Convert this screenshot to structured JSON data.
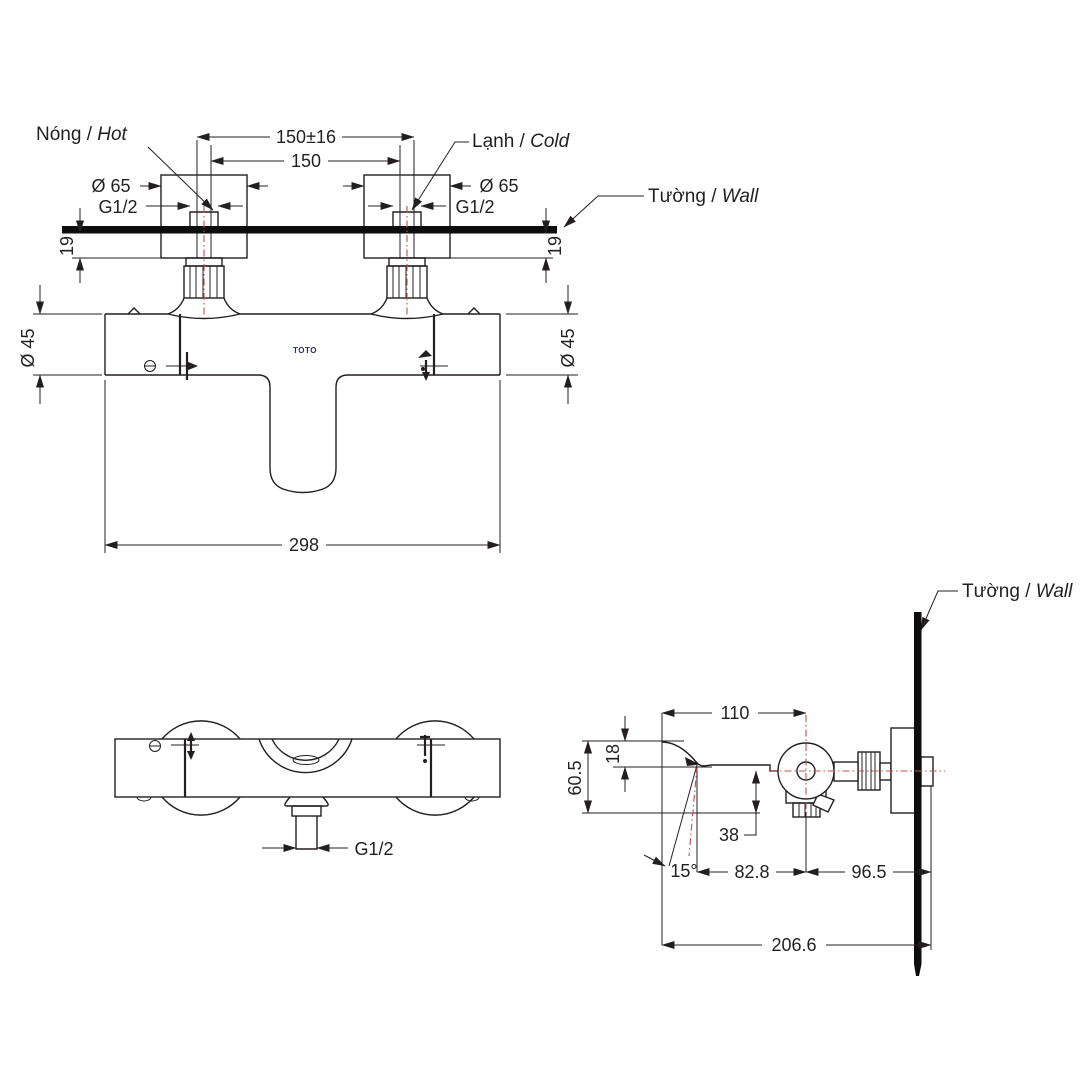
{
  "front_view": {
    "hot_label_vi": "Nóng / ",
    "hot_label_en": "Hot",
    "cold_label_vi": "Lạnh / ",
    "cold_label_en": "Cold",
    "wall_label_vi": "Tường / ",
    "wall_label_en": "Wall",
    "brand": "TOTO",
    "dims": {
      "center_tolerance": "150±16",
      "center_nominal": "150",
      "escutcheon_dia_left": "Ø 65",
      "escutcheon_dia_right": "Ø 65",
      "thread_left": "G1/2",
      "thread_right": "G1/2",
      "wall_offset_left": "19",
      "wall_offset_right": "19",
      "body_dia_left": "Ø 45",
      "body_dia_right": "Ø 45",
      "overall_width": "298"
    }
  },
  "top_view": {
    "dims": {
      "outlet_thread": "G1/2"
    }
  },
  "side_view": {
    "wall_label_vi": "Tường / ",
    "wall_label_en": "Wall",
    "dims": {
      "spout_reach": "110",
      "spout_drop": "18",
      "overall_height": "60.5",
      "outlet_depth": "38",
      "spout_angle": "15°",
      "tip_to_center": "82.8",
      "center_to_wall": "96.5",
      "overall_depth": "206.6"
    }
  },
  "colors": {
    "line": "#231f20",
    "centerline_red": "#c0504d",
    "wall_fill": "#0d0d0d",
    "brand_text": "#2b2b6e"
  }
}
